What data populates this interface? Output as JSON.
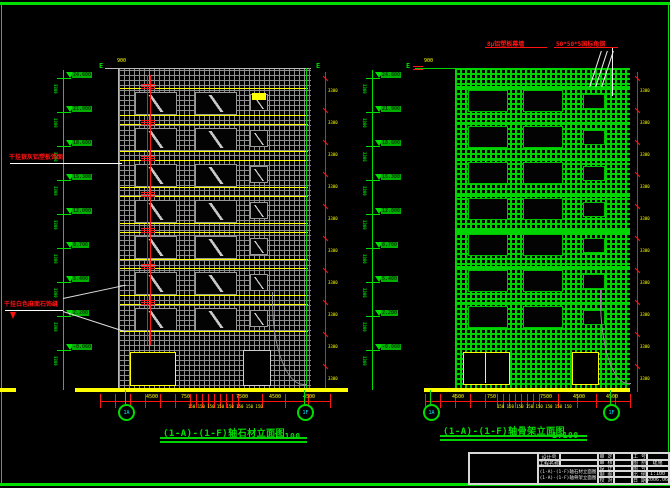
{
  "sheet": {
    "background": "#000000",
    "border_color": "#00dd00",
    "grid_stone_color": "#8f8f8f",
    "grid_frame_color": "#00d400",
    "ground_color": "#ffff00",
    "dimension_color": "#ff1414",
    "axis_color": "#00dd00"
  },
  "left_drawing": {
    "title": "(1-A)-(1-F)轴石材立面图",
    "scale": "1:100",
    "top_dim": "900",
    "section_mark_left": "E",
    "section_mark_right": "E",
    "annotation_upper": "干挂银灰铝塑板饰面",
    "annotation_lower": "干挂白色麻面石饰缝",
    "axis_bubble_left": "1A",
    "axis_bubble_right": "1F",
    "levels": [
      "24.600",
      "21.900",
      "18.600",
      "15.300",
      "12.000",
      "8.700",
      "5.400",
      "2.200",
      "-0.060"
    ],
    "level_interval": "3300",
    "bottom_dims": [
      {
        "label": "4500",
        "x": 146
      },
      {
        "label": "750",
        "x": 181
      },
      {
        "label": "7500",
        "x": 236
      },
      {
        "label": "4500",
        "x": 269
      },
      {
        "label": "4500",
        "x": 303
      }
    ],
    "bottom_subdims": "150 150 150 150 150 150 150 150",
    "side_levels": "3300"
  },
  "right_drawing": {
    "title": "(1-A)-(1-F)轴骨架立面图",
    "scale": "1:100",
    "top_dim": "900",
    "section_mark_left": "E",
    "section_mark_right": "E",
    "annotation_panel": "8μ铝塑板幕墙",
    "annotation_steel": "50*50*5国标角钢",
    "axis_bubble_left": "1A",
    "axis_bubble_right": "1F",
    "levels": [
      "24.600",
      "21.900",
      "18.600",
      "15.300",
      "12.000",
      "8.700",
      "5.400",
      "2.200",
      "-0.060"
    ],
    "level_interval": "3300",
    "bottom_dims": [
      {
        "label": "4500",
        "x": 452
      },
      {
        "label": "750",
        "x": 487
      },
      {
        "label": "7500",
        "x": 540
      },
      {
        "label": "4500",
        "x": 573
      },
      {
        "label": "4500",
        "x": 606
      }
    ],
    "bottom_subdims": "150 150 150 150 150 150 150 150",
    "side_levels": "3300"
  },
  "title_block": {
    "design_no_label": "设计号",
    "project_label": "工程名称",
    "drawing_names": [
      "(1-A)-(1-F)轴石材立面图",
      "(1-A)-(1-F)轴骨架立面图"
    ],
    "left_labels": [
      "审 定",
      "审 核",
      "设 计",
      "制 图",
      "校 对"
    ],
    "left_values": [
      "",
      "",
      "",
      "",
      ""
    ],
    "right_labels": [
      "工 号",
      "图 别",
      "图 号",
      "比 例",
      "日 期"
    ],
    "right_values": [
      "",
      "建施",
      "",
      "1:100",
      "2006.06"
    ]
  },
  "geometry_labels": {
    "floors": 7
  }
}
